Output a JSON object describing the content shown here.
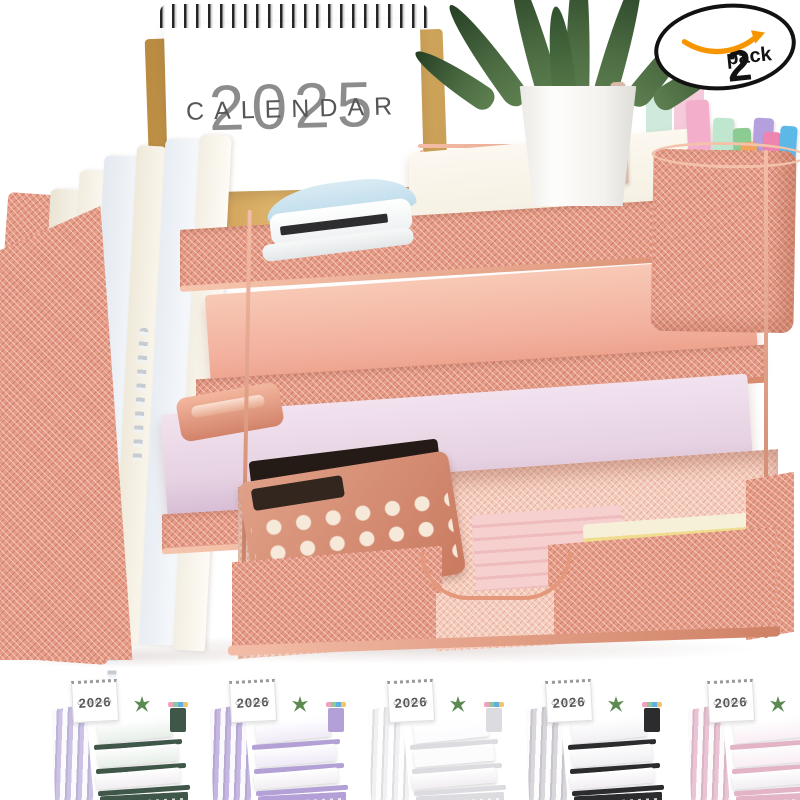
{
  "badge": {
    "count": "2",
    "label": "pack"
  },
  "calendar": {
    "year": "2025",
    "label": "CALENDAR"
  },
  "palette": {
    "rose_gold": "#e79c87",
    "rose_gold_light": "#f6cdbd",
    "rose_gold_deep": "#c87a5e",
    "kraft": "#cf9d58",
    "paper_white": "#f6f1e4",
    "paper_pink": "#f2b19e",
    "paper_lilac": "#e6d2e2",
    "plant_green": "#47663f",
    "pot_white": "#fcfcfa",
    "badge_orange": "#f79500",
    "calendar_year_text": "#8c8c8c",
    "calendar_label_text": "#565656",
    "stapler_blue": "#b9d9ea"
  },
  "pen_cup": {
    "marker_colors": [
      "#d8b9ab",
      "#cfe9dc",
      "#f5cbdb",
      "#f3aecb",
      "#bfe7d0",
      "#8ccb92",
      "#b4a0dc",
      "#f2a45c",
      "#ef84b0",
      "#5cb8e6",
      "#73cfc4"
    ]
  },
  "variants": [
    {
      "name": "dark-green",
      "calendar_year": "2026",
      "calendar_label": "CALENDAR",
      "frame_color": "#3f5749",
      "file_color": "#cdc2e6",
      "accent_color": "#e7efe8"
    },
    {
      "name": "purple",
      "calendar_year": "2026",
      "calendar_label": "CALENDAR",
      "frame_color": "#b2a0d6",
      "file_color": "#c6b6e2",
      "accent_color": "#f0ebf8"
    },
    {
      "name": "white",
      "calendar_year": "2026",
      "calendar_label": "CALENDAR",
      "frame_color": "#dcdce0",
      "file_color": "#f1f1f4",
      "accent_color": "#fbfbfd"
    },
    {
      "name": "black",
      "calendar_year": "2026",
      "calendar_label": "CALENDAR",
      "frame_color": "#2c2c2f",
      "file_color": "#d9d5dc",
      "accent_color": "#f1eff3"
    },
    {
      "name": "pink",
      "calendar_year": "2026",
      "calendar_label": "CALENDAR",
      "frame_color": "#e3b3c6",
      "file_color": "#eac4d4",
      "accent_color": "#f9eef4"
    }
  ]
}
